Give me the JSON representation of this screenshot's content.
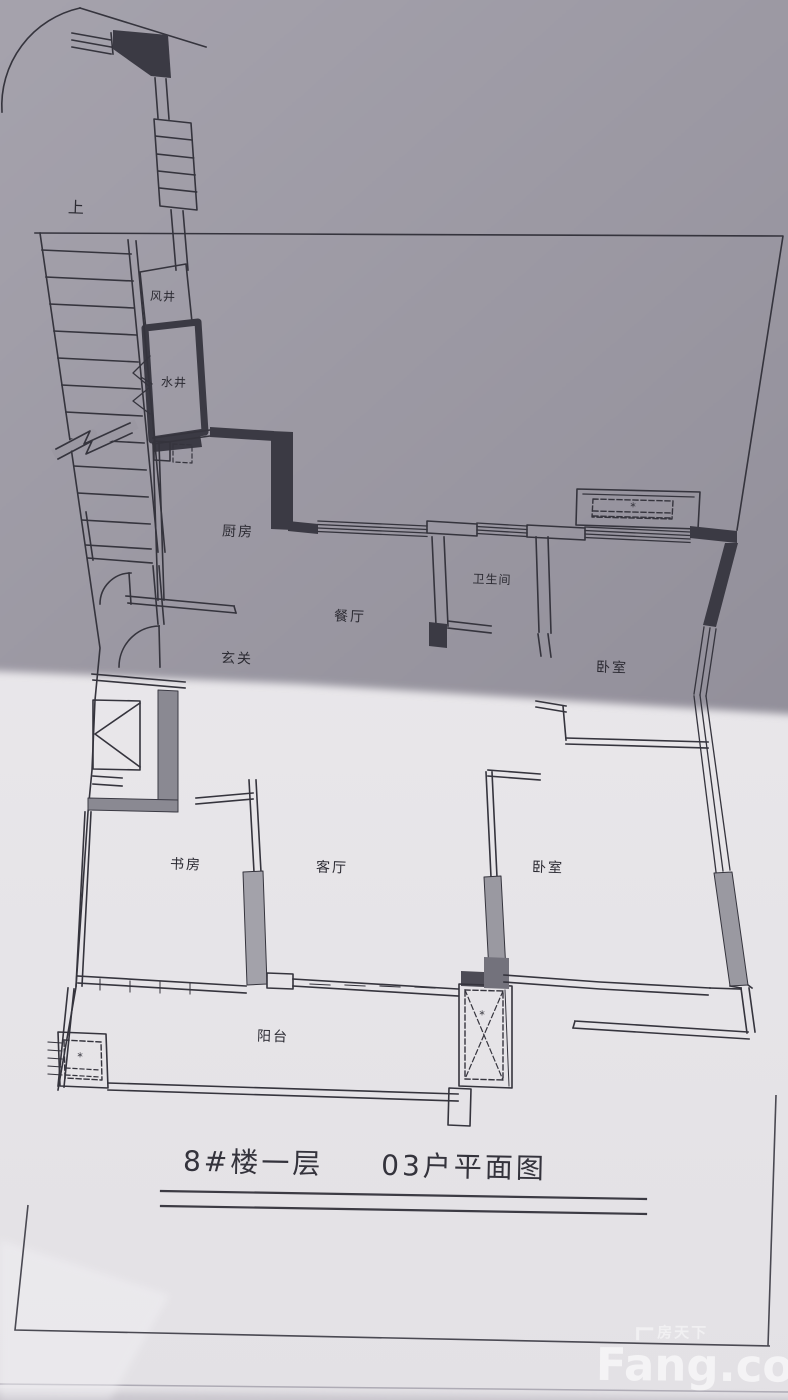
{
  "colors": {
    "paper_light": "#e9e7ea",
    "paper_shadow": "#9b98a2",
    "ink": "#35343d",
    "wall_dark": "#3b3a44",
    "wall_gray": "#8f8e97",
    "watermark": "#ffffff"
  },
  "plan": {
    "labels": {
      "stairs_up": "上",
      "shaft_air": "风井",
      "shaft_water": "水井",
      "kitchen": "厨房",
      "dining": "餐厅",
      "entry": "玄关",
      "bathroom": "卫生间",
      "bedroom_upper": "卧室",
      "study": "书房",
      "living": "客厅",
      "bedroom_lower": "卧室",
      "balcony": "阳台",
      "ac_symbol": "*"
    },
    "title": {
      "building": "8#楼一层",
      "unit": "03户平面图"
    }
  },
  "watermark": {
    "brand_cn": "房天下",
    "brand_en": "Fang.com"
  }
}
